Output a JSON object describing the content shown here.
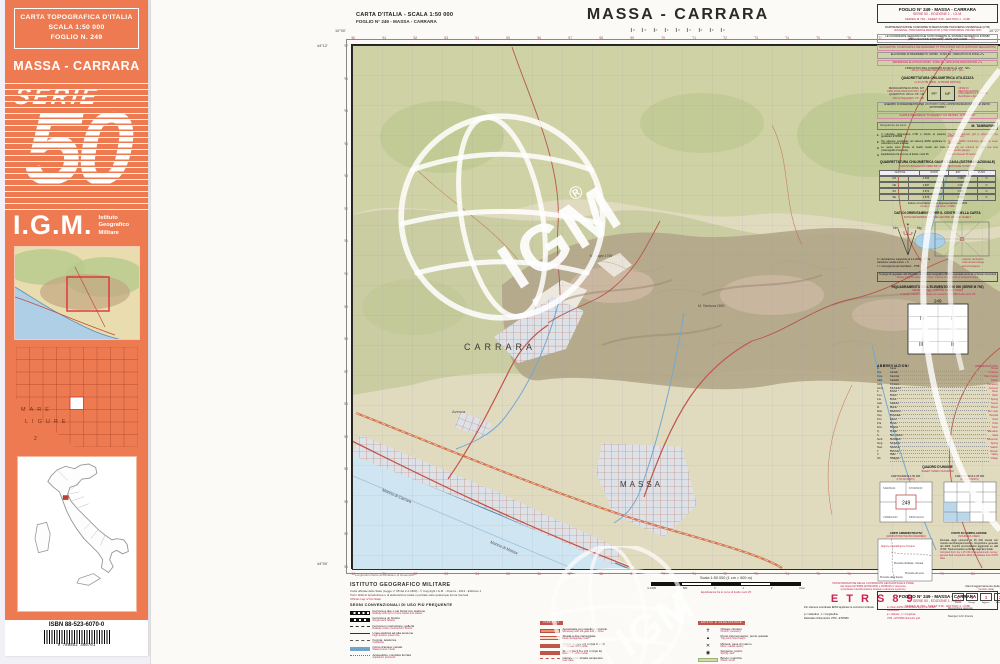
{
  "colors": {
    "cover_orange": "#ee7a52",
    "accent_red": "#c2285a",
    "road_red": "#c0554a",
    "sea_blue": "#cfe5f1"
  },
  "cover": {
    "header_lines": [
      "CARTA TOPOGRAFICA D'ITALIA",
      "SCALA 1:50 000",
      "FOGLIO N. 249"
    ],
    "title": "MASSA - CARRARA",
    "serie_word": "SERIE",
    "serie_number": "50",
    "igm": "I.G.M.",
    "igm_sub": [
      "Istituto",
      "Geografico",
      "Militare"
    ],
    "mare": "MARE",
    "ligure": "LIGURE",
    "index_num": "2",
    "isbn": "ISBN 88-523-6070-0",
    "barcode_digits": "9 788852 360701"
  },
  "sheet_header": {
    "line1": "CARTA D'ITALIA  -  SCALA 1:50 000",
    "line2": "FOGLIO N° 249 - MASSA - CARRARA",
    "title": "MASSA - CARRARA",
    "title_ticks": [
      "4'",
      "3'",
      "2'",
      "1'",
      "0'",
      "1'",
      "2'",
      "3'",
      "4'"
    ]
  },
  "map": {
    "labels": {
      "carrara": "CARRARA",
      "massa": "MASSA",
      "marina_carrara": "Marina di Carrara",
      "marina_massa": "Marina di Massa",
      "avenza": "Avenza",
      "peak1": "M. Sagro 1749",
      "peak2": "M. Tambura 1890"
    },
    "watermark": "IGM",
    "watermark_reg": "®",
    "corners": {
      "tl_lon": "10°00'",
      "tr_lon": "10°27'",
      "tl_lat": "44°12'",
      "bl_lat": "44°00'",
      "note": "Longitudini riferite al meridiano di Greenwich"
    },
    "top_ticks": [
      "'60",
      "'61",
      "'62",
      "'63",
      "'64",
      "'65",
      "'66",
      "'67",
      "'68",
      "'69",
      "'70",
      "'71",
      "'72",
      "'73",
      "'74",
      "'75",
      "'76",
      "'77",
      "'78",
      "'79",
      "'80",
      "'81"
    ],
    "bottom_ticks": [
      "'60",
      "'61",
      "'62",
      "'63",
      "'64",
      "'65",
      "'66",
      "'67",
      "'68",
      "'69",
      "'70",
      "'71",
      "'72",
      "'73",
      "'74",
      "'75",
      "'76",
      "'77",
      "'78",
      "'79",
      "'80",
      "'81"
    ],
    "left_ticks": [
      "'97",
      "'96",
      "'95",
      "'94",
      "'93",
      "'92",
      "'91",
      "'90",
      "'89",
      "'88",
      "'87",
      "'86",
      "'85",
      "'84",
      "'83",
      "'82",
      "'81"
    ],
    "right_ticks": [
      "'97",
      "'96",
      "'95",
      "'94",
      "'93",
      "'92",
      "'91",
      "'90",
      "'89",
      "'88",
      "'87",
      "'86",
      "'85",
      "'84",
      "'83",
      "'82",
      "'81"
    ]
  },
  "legend": {
    "igm_title": "ISTITUTO GEOGRAFICO MILITARE",
    "copy1": "Carta ufficiale dello Stato (Legge n° 68 del 2-2-1960) - © Copyright I.G.M. - Firenze - 2012 - Edizione 1",
    "copy2": "Tutti i diritti di riproduzione e di elaborazione totale o parziale sotto qualunque forma riservati",
    "copy3": "Official map of the State",
    "signs_title": "SEGNI CONVENZIONALI DI USO PIÙ FREQUENTE",
    "c1_bar": "VIABILITÀ",
    "c2_bar": "EDIFICI E VEGETAZIONE",
    "c0_rows": [
      {
        "sym": "s-rail2",
        "it": "Ferrovia a due o più binari con stazione",
        "en": "Railway with two or more tracks and station"
      },
      {
        "sym": "s-rail1",
        "it": "Ferrovia a un binario",
        "en": "Single-track railway"
      },
      {
        "sym": "s-dashk",
        "it": "Ferrovia in costruzione; galleria",
        "en": "Railway under construction; tunnel"
      },
      {
        "sym": "s-elec",
        "it": "Linea elettrica ad alta tensione",
        "en": "High-tension power line"
      },
      {
        "sym": "s-cable",
        "it": "Funivia, teleferica",
        "en": "Cableway"
      },
      {
        "sym": "s-river",
        "it": "Corso d'acqua; canale",
        "en": "Watercourse; canal"
      },
      {
        "sym": "s-aque",
        "it": "Acquedotto; condotta forzata",
        "en": "Aqueduct; penstock"
      }
    ],
    "c1_rows": [
      {
        "sym": "s-roadA",
        "it": "Autostrada con casello e svincolo",
        "en": "Motorway with toll-gate and junction"
      },
      {
        "sym": "s-road2",
        "it": "Strada a due carreggiate",
        "en": "Dual carriageway road"
      },
      {
        "sym": "s-road",
        "it": "Strada di oltre 3,5 m (tipi C e D)",
        "en": "Road over 3.5 m wide"
      },
      {
        "sym": "s-roadN",
        "it": "Strada fra 3,5 e 2,5 m (tipo E)",
        "en": "Road 3.5 - 2.5 m wide"
      },
      {
        "sym": "s-dash",
        "it": "Carrareccia, strada campestre",
        "en": "Cart track"
      },
      {
        "sym": "s-dot",
        "it": "Mulattiera, sentiero",
        "en": "Mule track, footpath"
      },
      {
        "sym": "s-gal",
        "it": "Strada in costruzione; galleria",
        "en": "Road under construction; tunnel"
      }
    ],
    "c2_rows": [
      {
        "sym": "s-glyph",
        "g": "✝",
        "it": "Chiesa; cimitero",
        "en": "Church; cemetery"
      },
      {
        "sym": "s-glyph",
        "g": "▴",
        "it": "Punto trigonometrico; punto quotato",
        "en": "Trig point; spot height"
      },
      {
        "sym": "s-glyph",
        "g": "✕",
        "it": "Miniera; cava di marmo",
        "en": "Mine; marble quarry"
      },
      {
        "sym": "s-glyph",
        "g": "◉",
        "it": "Sorgente; pozzo",
        "en": "Spring; well"
      },
      {
        "sym": "s-wood",
        "it": "Bosco; macchia",
        "en": "Wood; scrub"
      },
      {
        "sym": "s-vine",
        "it": "Vigneto; oliveto",
        "en": "Vineyard; olive grove"
      },
      {
        "sym": "s-contour",
        "it": "Curve di livello (equidistanza m 25)",
        "en": "Contours (interval 25 m)"
      }
    ],
    "scale_title": "Scala 1:50 000 (1 cm = 500 m)",
    "scale_labels": [
      "m 1000",
      "500",
      "0",
      "1",
      "2",
      "3 km"
    ],
    "equi": "Equidistanza fra le curve di livello metri 25",
    "etrs_lines": [
      "TRASFORMAZIONE DELLE COORDINATE GEOGRAFICHE E PIANE",
      "dai sistemi ETRS89 (ETRF2000) e ROMA40 e viceversa",
      "(coordinate transformations between reference systems)"
    ],
    "etrs_big": "E T R S 8 9",
    "etrs_rows": [
      {
        "b": "Per ottenere coordinate ED50 applicare le correzioni indicate",
        "r": "to obtain ED50 coordinates apply the shown corrections"
      },
      {
        "b": "φ = latitudine ;  λ = longitudine",
        "r": "φ = latitude ; λ = longitude"
      },
      {
        "b": "Reticolato chilometrico UTM - ETRS89",
        "r": "UTM - ETRS89 kilometric grid"
      }
    ],
    "rev_title_b": "Dati di aggiornamento della carta",
    "rev_title_r": "(revision data)",
    "rev_boxes": [
      {
        "n": "1",
        "l": "Rilievo"
      },
      {
        "n": "4",
        "l": "Ricogn."
      },
      {
        "n": "3",
        "l": "Aggiorn."
      },
      {
        "n": "2",
        "l": "Edizione"
      },
      {
        "n": "17",
        "l": "Stampa"
      }
    ],
    "rev_rows": [
      {
        "t": "Ricognizione generale",
        "g": "2003"
      },
      {
        "t": "Stampa I.G.M. Firenze",
        "g": "2012"
      }
    ]
  },
  "margin": {
    "header": [
      "FOGLIO N° 249 - MASSA - CARRARA",
      "SERIE 50 - EDIZIONE 1 - I.G.M.",
      "SERIES M 792 - SHEET 249 - EDITION 1 - IGMI"
    ],
    "proj_lines": [
      {
        "t": "RAPPRESENTAZIONE CONFORME DI MERCATORE TRASVERSA UNIVERSALE (UTM)",
        "c": "pl-b"
      },
      {
        "t": "UNIVERSAL TRANSVERSE MERCATOR (UTM) CONFORMAL PROJECTION",
        "c": "pl-r"
      },
      {
        "t": "LE COORDINATE GEOGRAFICHE SONO RIFERITE AL SISTEMA GEODETICO ETRS89 (REALIZZAZIONE ETRF2000) - RETE GPS IGM95",
        "c": "pl-bx"
      },
      {
        "t": "GEOGRAPHIC COORDINATES ARE REFERRED TO THE ETRS89 DATUM (ETRF2000 REALIZATION)",
        "c": "pl-rx"
      },
      {
        "t": "ELLISSOIDE DI RIFERIMENTO: GRS80 - FUSO 32 - INDICATIVO DI ZONA «T»",
        "c": "pl-bx"
      },
      {
        "t": "REFERENCE ELLIPSOID GRS80 - ZONE 32 - GRID ZONE DESIGNATION «T»",
        "c": "pl-rx"
      },
      {
        "t": "L'INDICATIVO DEL QUADRATO DI 100 km È «PP - NP»",
        "c": "pl-b"
      },
      {
        "t": "100 km SQUARE IDENTIFICATION «PP - NP»",
        "c": "pl-r"
      }
    ],
    "quad": {
      "tb": "QUADRETTATURA CHILOMETRICA UTILIZZATA",
      "tr": "(1 km UTM GRID - ETRS89 DATUM)",
      "l1": "DESIGNAZIONE DI ZONA: 32T",
      "l2": "GRID ZONE DESIGNATION: 32T",
      "l3": "QUADRATI DI 100 km: PP - NP",
      "l4": "100 km SQUARES: PP - NP",
      "cells": [
        "PP",
        "NP"
      ],
      "right": "CIFRE DI IDENTIFICAZIONE CHILOMETRICA (kilometric identification digits)",
      "ex_b": "ESEMPIO DI RIFERIMENTO PER UN PUNTO CON L'APPROSSIMAZIONE DI 100 METRI: 32TPP608847",
      "ex_r": "SAMPLE REFERENCE TO NEAREST 100 METRES: 32TPP608847",
      "sig_a": "Designazione del punto",
      "sig_b": "M. TAMBURINI"
    },
    "nums": [
      {
        "n": "1.",
        "b": "Il reticolato chilometrico UTM è riferito al sistema geodetico ETRS89.",
        "r": "The UTM kilometric grid is referred to the ETRS89 datum."
      },
      {
        "n": "2.",
        "b": "Per ottenere coordinate nel sistema ED50 applicare le variazioni medie indicate.",
        "r": "To obtain ED50 coordinates apply the mean shifts shown."
      },
      {
        "n": "3.",
        "b": "Le quote sono riferite al livello medio del mare (mareografo di Genova).",
        "r": "Elevations are referred to mean sea level (Genova tide gauge)."
      },
      {
        "n": "4.",
        "b": "Equidistanza fra le curve di livello: metri 25.",
        "r": "Contour interval: 25 metres."
      }
    ],
    "gauss": {
      "tb": "QUADRETTATURA CHILOMETRICA GAUSS-BOAGA (SISTEMA NAZIONALE)",
      "tr": "GAUSS-BOAGA KILOMETRIC GRID (NATIONAL SYSTEM)",
      "h": [
        "VERTICE",
        "NORD",
        "EST",
        "FUSO"
      ],
      "rows": [
        {
          "c0": "NO",
          "c1": "4 896",
          "c2": "1 585",
          "c3": "O"
        },
        {
          "c0": "NE",
          "c1": "4 897",
          "c2": "1 612",
          "c3": "O"
        },
        {
          "c0": "SO",
          "c1": "4 874",
          "c2": "1 586",
          "c3": "O"
        },
        {
          "c0": "SE",
          "c1": "4 875",
          "c2": "1 613",
          "c3": "O"
        }
      ],
      "nb": "Fattore di contrazione della rappresentazione: 0,9996",
      "nr": "Linear contraction factor: 0.9996"
    },
    "orient": {
      "tb": "DATI DI ORIENTAMENTO PER IL CENTRO DELLA CARTA",
      "tr": "DATA REFERRED TO THE CENTRE OF THE SHEET",
      "star": "✶",
      "nm": "Nm",
      "ng": "Ng",
      "delta": "δ",
      "conv": "c",
      "rows": [
        {
          "b": "δ = declinazione magnetica al 1-1-2012: 1°52' E",
          "r": "magnetic declination"
        },
        {
          "b": "variazione media annua: + 6'",
          "r": "mean annual change"
        },
        {
          "b": "c = convergenza del meridiano: - 0°58'",
          "r": "grid convergence"
        }
      ]
    },
    "notebox": {
      "b": "Si prega di segnalare alla Direzione dell'Istituto Geografico Militare eventuali errori od omissioni riscontrati",
      "r": "Please notify the Director of I.G.M. - Firenze of any errors or omissions noted"
    },
    "riquad": {
      "tb": "RIQUADRAMENTO DELL'ELEMENTO 1:50 000 (SERIE M 792)",
      "tr": "SERIES M 792 - 1:50 000 SHEET LINES",
      "tr2": "I margini interni individuano le sezioni 1:25 000 della serie 25",
      "sheet": "249",
      "q1": "IV",
      "q2": "I",
      "q3": "III",
      "q4": "II"
    },
    "abbrev_title": "ABBREVIAZIONI",
    "abbrev_en": "(ABBREVIATIONS)",
    "abbrev": [
      {
        "a": "C.",
        "m": "Casa",
        "e": "House"
      },
      {
        "a": "C.le",
        "m": "Canale",
        "e": "Channel"
      },
      {
        "a": "C.na",
        "m": "Cascina",
        "e": "Farm house"
      },
      {
        "a": "Cast.",
        "m": "Castello",
        "e": "Castle"
      },
      {
        "a": "Cim.",
        "m": "Cimitero",
        "e": "Cemetery"
      },
      {
        "a": "Conv.",
        "m": "Convento",
        "e": "Convent"
      },
      {
        "a": "F.",
        "m": "Fiume",
        "e": "River"
      },
      {
        "a": "F.so",
        "m": "Fosso",
        "e": "Ditch"
      },
      {
        "a": "F.te",
        "m": "Fonte",
        "e": "Spring"
      },
      {
        "a": "Gall.",
        "m": "Galleria",
        "e": "Tunnel"
      },
      {
        "a": "M.",
        "m": "Monte",
        "e": "Mount"
      },
      {
        "a": "Mad.",
        "m": "Madonna",
        "e": "Our Lady"
      },
      {
        "a": "Osp.",
        "m": "Ospedale",
        "e": "Hospital"
      },
      {
        "a": "P.so",
        "m": "Passo",
        "e": "Pass"
      },
      {
        "a": "P.ta",
        "m": "Punta",
        "e": "Point"
      },
      {
        "a": "Pod.",
        "m": "Podere",
        "e": "Farm"
      },
      {
        "a": "Q.",
        "m": "Quota",
        "e": "Elevation"
      },
      {
        "a": "S.",
        "m": "San, Santo",
        "e": "Saint"
      },
      {
        "a": "Serb.",
        "m": "Serbatoio",
        "e": "Reservoir"
      },
      {
        "a": "Sorg.",
        "m": "Sorgente",
        "e": "Spring"
      },
      {
        "a": "Staz.",
        "m": "Stazione",
        "e": "Station"
      },
      {
        "a": "T.",
        "m": "Torrente",
        "e": "Stream"
      },
      {
        "a": "V.",
        "m": "Valle",
        "e": "Valley"
      },
      {
        "a": "Vill.",
        "m": "Villaggio",
        "e": "Village"
      }
    ],
    "quadro": {
      "tb": "QUADRO D'UNIONE",
      "tr": "SHEET INDEX DIAGRAM",
      "d1b": "CARTOGRAFIA 1:50 000",
      "d1r": "(1:50 000 MAPS)",
      "d2b": "CARTOGRAFIA 1:25 000",
      "d2r": "(1:25 000 MAPS)",
      "center": "249",
      "cells": [
        "SARZANA",
        "FIVIZZANO",
        "VIAREGGIO",
        "PESCAGLIA"
      ]
    },
    "limiti": {
      "tb": "LIMITI AMMINISTRATIVI",
      "tr": "(ADMINISTRATIVE BOUNDARIES)",
      "massa": "Provincia di Massa - Carrara",
      "lucca": "Provincia di Lucca",
      "spezia": "Provincia della Spezia",
      "toscana": "Regione Toscana",
      "liguria": "Regione Liguria"
    },
    "fonti": {
      "tb": "FONTI DI COMPILAZIONE",
      "tr": "(SOURCES USED)",
      "b": "Derivata dagli elementi al 25 000 rilevati con metodo aerofotogrammetrico; ricognizione generale del 2003. Confini amministrativi aggiornati su dati ISTAT. Toponomastica verificata dagli Enti locali.",
      "r": "Compiled from the 1:25 000 photogrammetric survey; general field completion 2003; boundaries from ISTAT data."
    }
  }
}
